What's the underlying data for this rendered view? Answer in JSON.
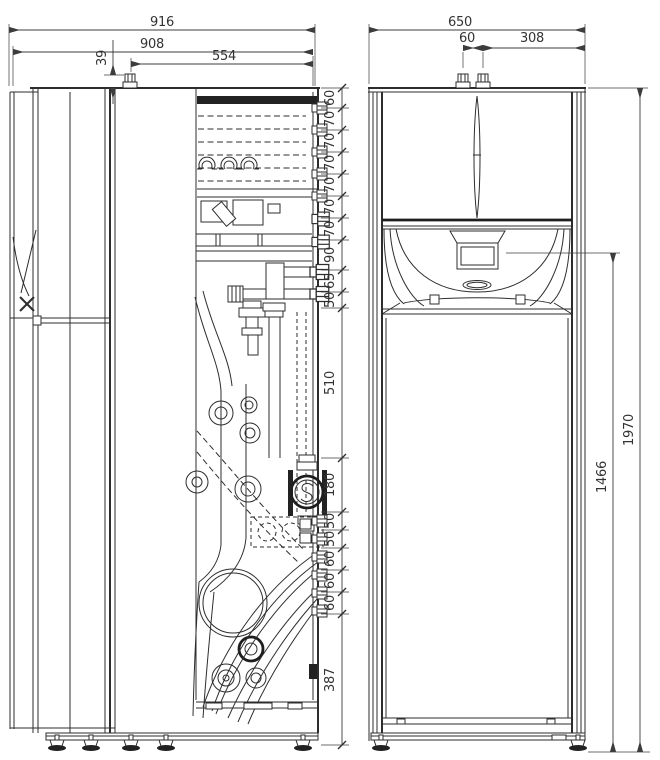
{
  "dims": {
    "side_width_outer": "916",
    "side_width_inner": "908",
    "top_offset": "39",
    "connector_offset": "554",
    "front_width": "650",
    "front_top_gap": "60",
    "front_top_right": "308",
    "height_partial": "1466",
    "height_total": "1970",
    "chain": [
      "60",
      "70",
      "70",
      "70",
      "70",
      "70",
      "70",
      "90",
      "65",
      "50",
      "510",
      "180",
      "50",
      "50",
      "60",
      "60",
      "60",
      "387"
    ]
  }
}
